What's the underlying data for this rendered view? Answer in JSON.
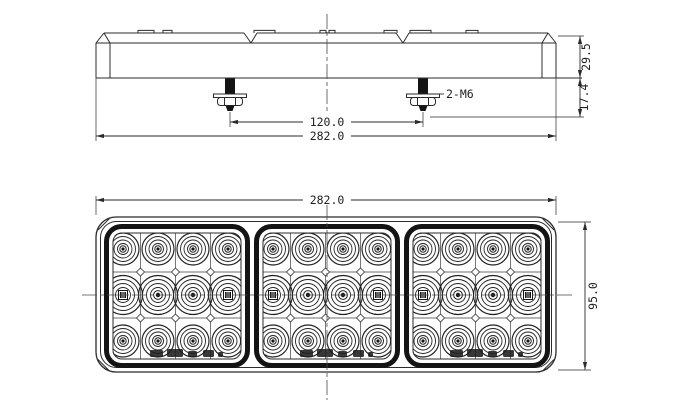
{
  "colors": {
    "ink": "#2b2b2b",
    "heavy_ink": "#141414",
    "background": "#ffffff"
  },
  "top_view": {
    "dim_overall_width": "282.0",
    "dim_stud_spacing": "120.0",
    "stud_callout": "2-M6",
    "dim_body_height": "29.5",
    "dim_stud_length": "17.4"
  },
  "front_view": {
    "dim_overall_width": "282.0",
    "dim_overall_height": "95.0"
  },
  "diagram": {
    "type": "engineering-drawing",
    "views": [
      "side-elevation-with-mounting-studs",
      "front-elevation-led-lens"
    ],
    "stud_count": 2,
    "stud_thread": "M6",
    "stud_positions_x": [
      230,
      423
    ],
    "stud_top_y": 78,
    "lens_section_count": 3,
    "section_origins_x": [
      104,
      254,
      404
    ],
    "section_origin_y": 224,
    "section_size": [
      146,
      144
    ],
    "led_grid": {
      "rows": 3,
      "cols": 4,
      "col_offsets": [
        19,
        54,
        89,
        124
      ],
      "row_offsets": [
        25,
        71,
        117
      ],
      "row_radii": [
        [
          16,
          12.5,
          9,
          5.5
        ],
        [
          19.5,
          15.5,
          11.5,
          7.5
        ],
        [
          16,
          12.5,
          9,
          5.5
        ]
      ],
      "square_center_cells": "middle row, outer columns"
    },
    "certification_mark_offsets": [
      [
        46,
        126,
        13,
        7
      ],
      [
        63,
        125,
        16,
        8
      ],
      [
        84,
        127,
        9,
        6
      ],
      [
        99,
        126,
        11,
        7
      ],
      [
        114,
        128,
        5,
        5
      ]
    ]
  }
}
